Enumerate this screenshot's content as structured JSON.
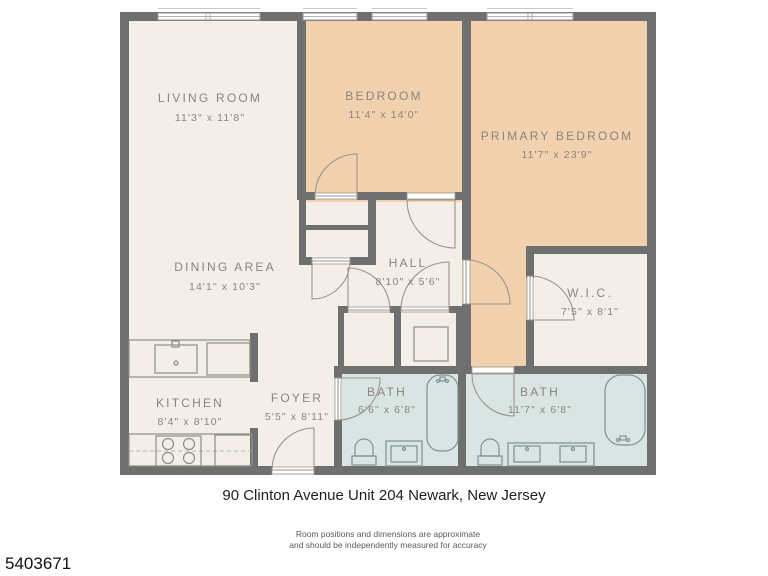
{
  "title": {
    "address": "90 Clinton Avenue Unit 204 Newark, New Jersey"
  },
  "footer": {
    "disclaimer_line1": "Room positions and dimensions are approximate",
    "disclaimer_line2": "and should be independently measured for accuracy",
    "listing_id": "5403671"
  },
  "rooms": [
    {
      "id": "living-room",
      "name": "LIVING ROOM",
      "dims": "11'3\" x 11'8\""
    },
    {
      "id": "bedroom",
      "name": "BEDROOM",
      "dims": "11'4\" x 14'0\""
    },
    {
      "id": "primary-bedroom",
      "name": "PRIMARY BEDROOM",
      "dims": "11'7\" x 23'9\""
    },
    {
      "id": "dining-area",
      "name": "DINING AREA",
      "dims": "14'1\" x 10'3\""
    },
    {
      "id": "hall",
      "name": "HALL",
      "dims": "8'10\" x 5'6\""
    },
    {
      "id": "wic",
      "name": "W.I.C.",
      "dims": "7'5\" x 8'1\""
    },
    {
      "id": "kitchen",
      "name": "KITCHEN",
      "dims": "8'4\" x 8'10\""
    },
    {
      "id": "foyer",
      "name": "FOYER",
      "dims": "5'5\" x 8'11\""
    },
    {
      "id": "bath-1",
      "name": "BATH",
      "dims": "6'6\" x 6'8\""
    },
    {
      "id": "bath-2",
      "name": "BATH",
      "dims": "11'7\" x 6'8\""
    }
  ],
  "colors": {
    "wall": "#6f6f6f",
    "floor_main": "#f3eee7",
    "floor_bedroom": "#f2d1af",
    "floor_bath": "#d9e5e3",
    "label_text": "#8b857d"
  }
}
